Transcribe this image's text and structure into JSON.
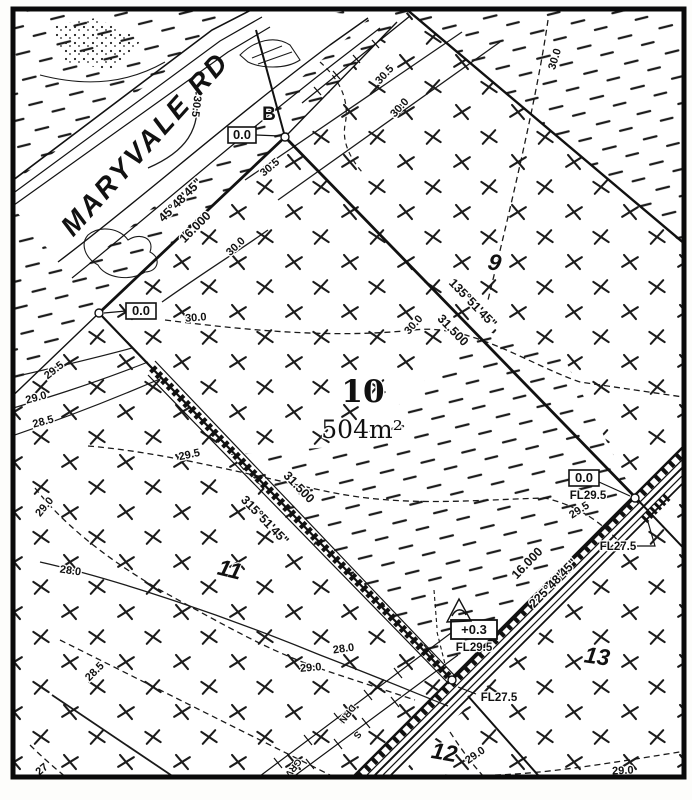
{
  "road": {
    "name": "MARYVALE RD"
  },
  "survey_point": {
    "label": "B"
  },
  "main_lot": {
    "number": "10",
    "area": "504m²"
  },
  "adjacent_lots": {
    "northeast": "9",
    "southwest": "11",
    "south": "12",
    "southeast": "13"
  },
  "boundaries": {
    "northwest": {
      "bearing": "45°48'45\"",
      "distance": "16.000"
    },
    "northeast": {
      "bearing": "135°51'45\"",
      "distance": "31.500"
    },
    "southwest": {
      "bearing": "315°51'45\"",
      "distance": "31.500"
    },
    "southeast": {
      "bearing": "225°48'45\"",
      "distance": "16.000"
    }
  },
  "level_annotations": {
    "corner_b": "0.0",
    "corner_west": "0.0",
    "corner_east": "0.0",
    "fill_depth": "+0.3",
    "floor_levels": {
      "east_upper": "FL29.5",
      "east_lower": "FL27.5",
      "south_upper": "FL29.5",
      "south_lower": "FL27.5"
    }
  },
  "contour_labels": [
    {
      "text": "30.5"
    },
    {
      "text": "30.5"
    },
    {
      "text": "30.0"
    },
    {
      "text": "30.0"
    },
    {
      "text": "30.0"
    },
    {
      "text": "30.0"
    },
    {
      "text": "30.0"
    },
    {
      "text": "30.5"
    },
    {
      "text": "29.5"
    },
    {
      "text": "29.0"
    },
    {
      "text": "28.5"
    },
    {
      "text": "29.5"
    },
    {
      "text": "29.5"
    },
    {
      "text": "29.0"
    },
    {
      "text": "28.0"
    },
    {
      "text": "29.0"
    },
    {
      "text": "28.0"
    },
    {
      "text": "28.5"
    },
    {
      "text": "27"
    },
    {
      "text": "29.0"
    },
    {
      "text": "29.0"
    }
  ],
  "service_labels": {
    "drain": "DRN",
    "sewer": "S",
    "gravel": "GRV"
  }
}
